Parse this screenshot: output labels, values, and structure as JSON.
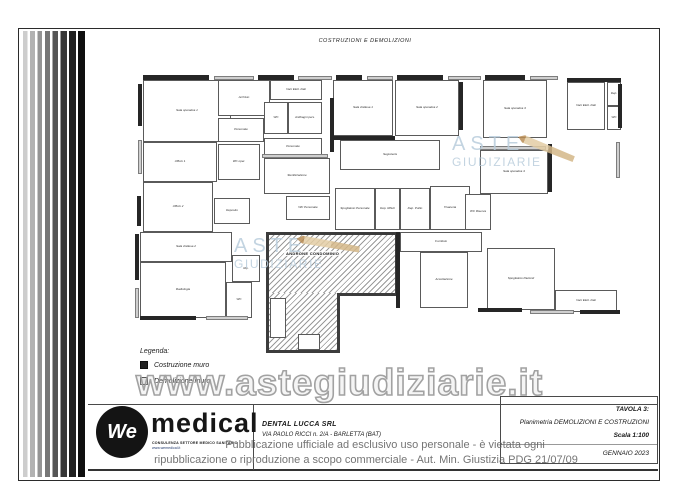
{
  "page": {
    "top_title": "COSTRUZIONI E DEMOLIZIONI"
  },
  "watermarks": {
    "large": "www.astegiudiziarie.it",
    "aste_line1": "ASTE",
    "aste_line2": "GIUDIZIARIE",
    "notice_line1": "Pubblicazione ufficiale ad esclusivo uso personale - è vietata ogni",
    "notice_line2": "ripubblicazione o riproduzione a scopo commerciale - Aut. Min. Giustizia PDG 21/07/09"
  },
  "legend": {
    "title": "Legenda:",
    "items": [
      {
        "label": "Costruzione muro"
      },
      {
        "label": "Demolizione muro"
      }
    ]
  },
  "logo": {
    "mark": "We",
    "brand": "medical",
    "caption1": "CONSULENZA SETTORE MEDICO SANITARIO",
    "caption2": "www.wemedical.it"
  },
  "title_block": {
    "company": "DENTAL LUCCA SRL",
    "address": "VIA PAOLO RICCI n. 2/A - BARLETTA (BAT)",
    "tavola": "TAVOLA 3:",
    "subject": "Planimetria DEMOLIZIONI E COSTRUZIONI",
    "scale": "Scala 1:100",
    "date": "GENNAIO 2023"
  },
  "plan": {
    "andron_label": "ANDRONE CONDOMINIO",
    "rooms": [
      {
        "label": "Sala operativa 1",
        "x": 143,
        "y": 80,
        "w": 88,
        "h": 62
      },
      {
        "label": "Ufficio 1",
        "x": 143,
        "y": 142,
        "w": 74,
        "h": 40
      },
      {
        "label": "Ufficio 2",
        "x": 143,
        "y": 182,
        "w": 70,
        "h": 50
      },
      {
        "label": "Archivio",
        "x": 218,
        "y": 80,
        "w": 52,
        "h": 36
      },
      {
        "label": "Personale",
        "x": 218,
        "y": 118,
        "w": 46,
        "h": 24
      },
      {
        "label": "WC oper.",
        "x": 218,
        "y": 144,
        "w": 42,
        "h": 36
      },
      {
        "label": "Deposito",
        "x": 214,
        "y": 198,
        "w": 36,
        "h": 26
      },
      {
        "label": "Vani Elett. Dati",
        "x": 270,
        "y": 80,
        "w": 52,
        "h": 20
      },
      {
        "label": "WC",
        "x": 264,
        "y": 102,
        "w": 24,
        "h": 32
      },
      {
        "label": "Antibagni pers.",
        "x": 288,
        "y": 102,
        "w": 34,
        "h": 32
      },
      {
        "label": "Personale",
        "x": 264,
        "y": 138,
        "w": 58,
        "h": 18
      },
      {
        "label": "Sterilizzazione",
        "x": 264,
        "y": 158,
        "w": 66,
        "h": 36
      },
      {
        "label": "WC Personale",
        "x": 286,
        "y": 196,
        "w": 44,
        "h": 24
      },
      {
        "label": "Sala d'attesa 1",
        "x": 333,
        "y": 80,
        "w": 60,
        "h": 56
      },
      {
        "label": "Sala operativa 2",
        "x": 395,
        "y": 80,
        "w": 64,
        "h": 56
      },
      {
        "label": "Sala operativa 3",
        "x": 483,
        "y": 80,
        "w": 64,
        "h": 58
      },
      {
        "label": "Segreteria",
        "x": 340,
        "y": 140,
        "w": 100,
        "h": 30
      },
      {
        "label": "Sala operativa 4",
        "x": 480,
        "y": 150,
        "w": 68,
        "h": 44
      },
      {
        "label": "Vani Elett. Dati",
        "x": 567,
        "y": 82,
        "w": 38,
        "h": 48
      },
      {
        "label": "Dep.",
        "x": 607,
        "y": 82,
        "w": 14,
        "h": 24
      },
      {
        "label": "WC",
        "x": 607,
        "y": 106,
        "w": 14,
        "h": 24
      },
      {
        "label": "Spogliatoio Personale",
        "x": 335,
        "y": 188,
        "w": 40,
        "h": 42
      },
      {
        "label": "Dep. Rifiuti",
        "x": 375,
        "y": 188,
        "w": 25,
        "h": 42
      },
      {
        "label": "Dep. Pulito",
        "x": 400,
        "y": 188,
        "w": 30,
        "h": 42
      },
      {
        "label": "Tisaneria",
        "x": 430,
        "y": 186,
        "w": 40,
        "h": 44
      },
      {
        "label": "WC Riserva",
        "x": 465,
        "y": 194,
        "w": 26,
        "h": 36
      },
      {
        "label": "Sala d'attesa 2",
        "x": 140,
        "y": 232,
        "w": 92,
        "h": 30
      },
      {
        "label": "Radiologia",
        "x": 140,
        "y": 262,
        "w": 86,
        "h": 56
      },
      {
        "label": "WC",
        "x": 226,
        "y": 282,
        "w": 26,
        "h": 36
      },
      {
        "label": "Rip.",
        "x": 232,
        "y": 255,
        "w": 28,
        "h": 27
      },
      {
        "label": "Corridoio",
        "x": 400,
        "y": 232,
        "w": 82,
        "h": 20
      },
      {
        "label": "Accettazione",
        "x": 420,
        "y": 252,
        "w": 48,
        "h": 56
      },
      {
        "label": "Spogliatoio Pazienti",
        "x": 487,
        "y": 248,
        "w": 68,
        "h": 62
      },
      {
        "label": "Vani Elett. Dati",
        "x": 555,
        "y": 290,
        "w": 62,
        "h": 22
      }
    ],
    "walls": [
      {
        "x": 143,
        "y": 75,
        "w": 66,
        "h": 5,
        "t": "c"
      },
      {
        "x": 214,
        "y": 76,
        "w": 40,
        "h": 4,
        "t": "d"
      },
      {
        "x": 258,
        "y": 75,
        "w": 36,
        "h": 5,
        "t": "c"
      },
      {
        "x": 298,
        "y": 76,
        "w": 34,
        "h": 4,
        "t": "d"
      },
      {
        "x": 336,
        "y": 75,
        "w": 26,
        "h": 5,
        "t": "c"
      },
      {
        "x": 367,
        "y": 76,
        "w": 26,
        "h": 4,
        "t": "d"
      },
      {
        "x": 397,
        "y": 75,
        "w": 46,
        "h": 5,
        "t": "c"
      },
      {
        "x": 448,
        "y": 76,
        "w": 33,
        "h": 4,
        "t": "d"
      },
      {
        "x": 485,
        "y": 75,
        "w": 40,
        "h": 5,
        "t": "c"
      },
      {
        "x": 530,
        "y": 76,
        "w": 28,
        "h": 4,
        "t": "d"
      },
      {
        "x": 567,
        "y": 78,
        "w": 54,
        "h": 4,
        "t": "c"
      },
      {
        "x": 138,
        "y": 84,
        "w": 4,
        "h": 42,
        "t": "c"
      },
      {
        "x": 138,
        "y": 140,
        "w": 4,
        "h": 34,
        "t": "d"
      },
      {
        "x": 137,
        "y": 196,
        "w": 4,
        "h": 30,
        "t": "c"
      },
      {
        "x": 135,
        "y": 234,
        "w": 4,
        "h": 46,
        "t": "c"
      },
      {
        "x": 135,
        "y": 288,
        "w": 4,
        "h": 30,
        "t": "d"
      },
      {
        "x": 618,
        "y": 84,
        "w": 4,
        "h": 44,
        "t": "c"
      },
      {
        "x": 616,
        "y": 142,
        "w": 4,
        "h": 36,
        "t": "d"
      },
      {
        "x": 330,
        "y": 98,
        "w": 4,
        "h": 54,
        "t": "c"
      },
      {
        "x": 459,
        "y": 82,
        "w": 4,
        "h": 48,
        "t": "c"
      },
      {
        "x": 548,
        "y": 144,
        "w": 4,
        "h": 48,
        "t": "c"
      },
      {
        "x": 396,
        "y": 232,
        "w": 4,
        "h": 76,
        "t": "c"
      },
      {
        "x": 140,
        "y": 316,
        "w": 56,
        "h": 4,
        "t": "c"
      },
      {
        "x": 206,
        "y": 316,
        "w": 42,
        "h": 4,
        "t": "d"
      },
      {
        "x": 478,
        "y": 308,
        "w": 44,
        "h": 4,
        "t": "c"
      },
      {
        "x": 530,
        "y": 310,
        "w": 44,
        "h": 4,
        "t": "d"
      },
      {
        "x": 580,
        "y": 310,
        "w": 40,
        "h": 4,
        "t": "c"
      },
      {
        "x": 262,
        "y": 154,
        "w": 66,
        "h": 4,
        "t": "d"
      },
      {
        "x": 333,
        "y": 136,
        "w": 62,
        "h": 4,
        "t": "c"
      },
      {
        "x": 480,
        "y": 146,
        "w": 66,
        "h": 4,
        "t": "d"
      },
      {
        "x": 270,
        "y": 298,
        "w": 16,
        "h": 40,
        "t": "w"
      },
      {
        "x": 298,
        "y": 334,
        "w": 22,
        "h": 16,
        "t": "w"
      }
    ]
  },
  "colors": {
    "aste_blue": "#b9cddc",
    "pencil_tan": "#d9b98c",
    "wall_dark": "#262626",
    "wall_light": "#cfcfcf",
    "watermark_gray": "#9e9e9e",
    "notice_gray": "#696969"
  }
}
